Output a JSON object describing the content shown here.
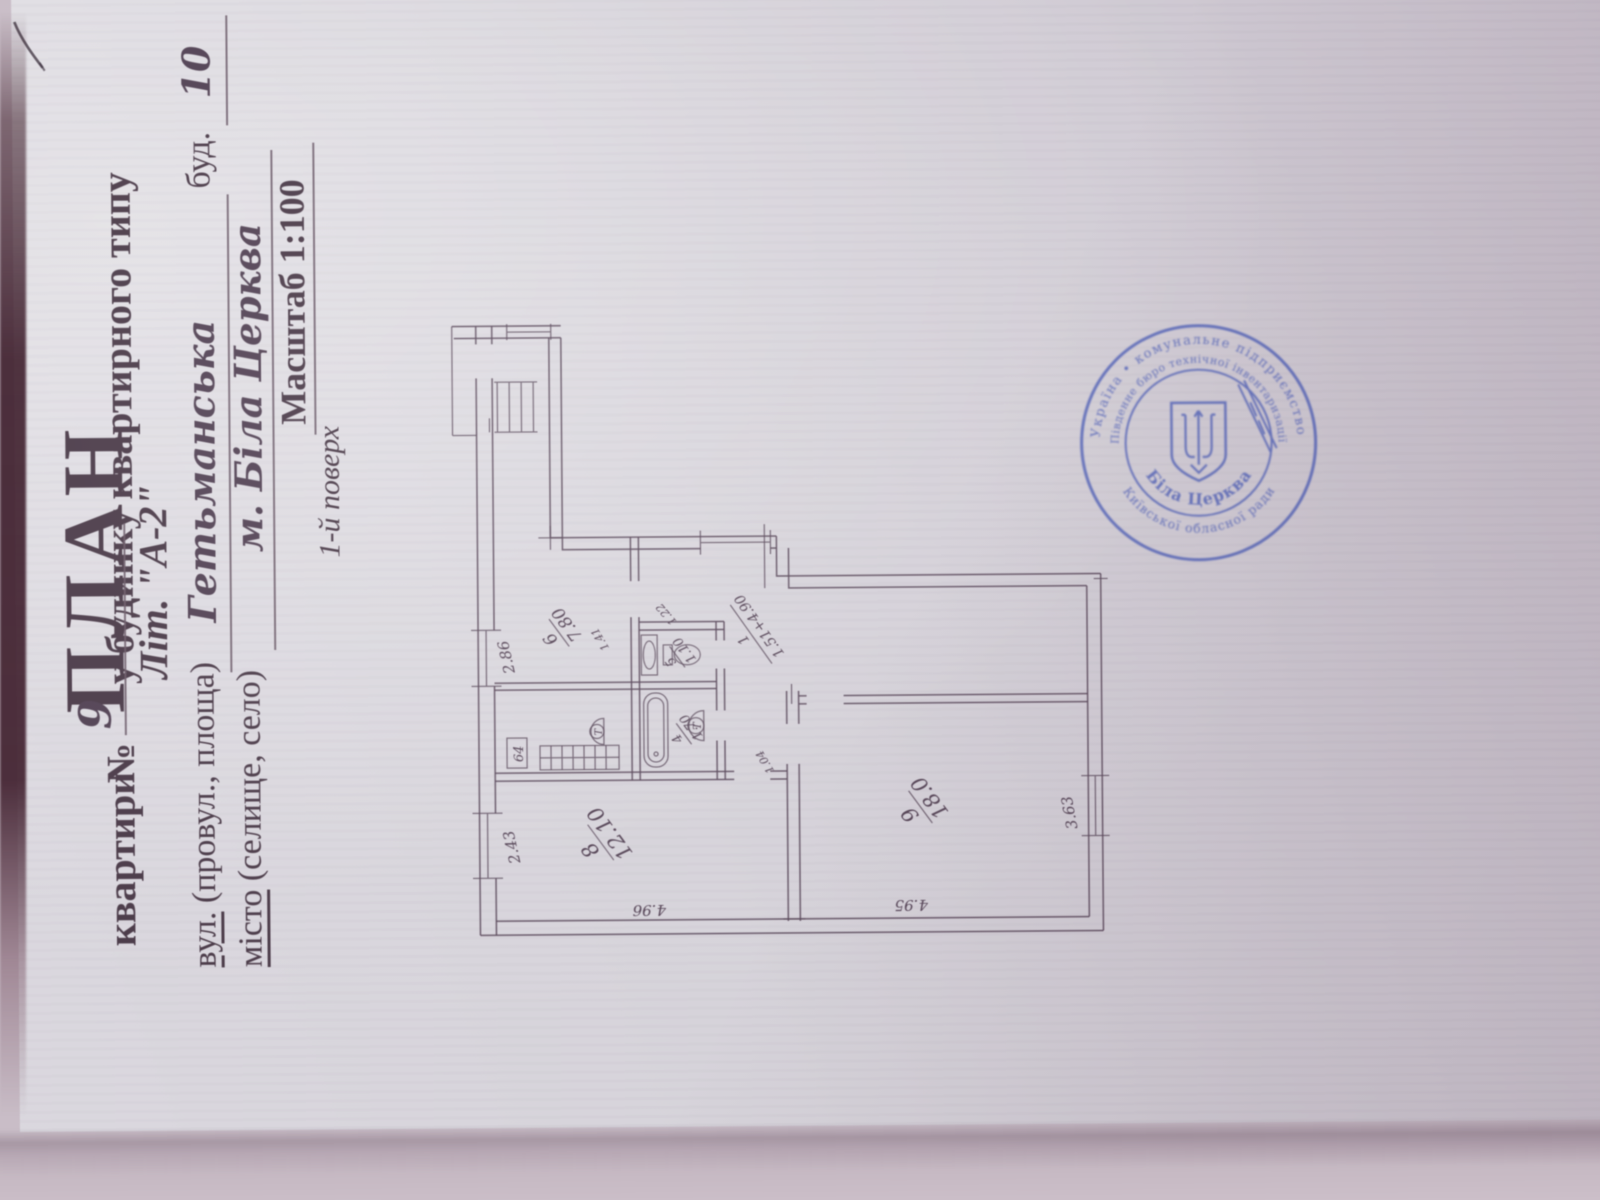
{
  "document": {
    "title": "ПЛАН",
    "subtitle": {
      "part1": "квартири",
      "no_sign": "№",
      "apartment_number": "9",
      "part2": "у будинку квартирного типу"
    },
    "letter": "Літ. \"А-2\"",
    "street": {
      "label_head": "вул.",
      "label_tail": " (провул., площа)",
      "value": "Гетьманська",
      "building_label": "буд.",
      "building_number": "10"
    },
    "city": {
      "label_head": "місто",
      "label_tail": " (селище, село)",
      "value": "м. Біла Церква"
    },
    "scale": "Масштаб 1:100",
    "floor": "1-й поверх"
  },
  "plan": {
    "rooms": [
      {
        "number": "8",
        "area": "12.10"
      },
      {
        "number": "9",
        "area": "18.0"
      },
      {
        "number": "6",
        "area": "7.80"
      },
      {
        "number": "5",
        "area": "1.10"
      },
      {
        "number": "4",
        "area": "1.70"
      },
      {
        "number": "1",
        "area": "1.51+4.90"
      }
    ],
    "dimensions": {
      "d243": "2.43",
      "d496": "4.96",
      "d286": "2.86",
      "d495": "4.95",
      "d363": "3.63",
      "d141": "1.41",
      "d122": "1.22",
      "d104": "1.04"
    },
    "fixtures": {
      "duct_box": "64",
      "heater_mark": "Т"
    }
  },
  "stamp": {
    "ring_outer_top": "Україна  •  комунальне підприємство",
    "ring_outer_bottom": "Київської обласної ради",
    "ring_inner_top": "«Південне бюро технічної інвентаризації»",
    "ring_inner_bottom": "Біла Церква"
  },
  "colors": {
    "ink": "#4a3a48",
    "stamp_blue": "#5565b8",
    "paper": "#d5d2d9"
  }
}
